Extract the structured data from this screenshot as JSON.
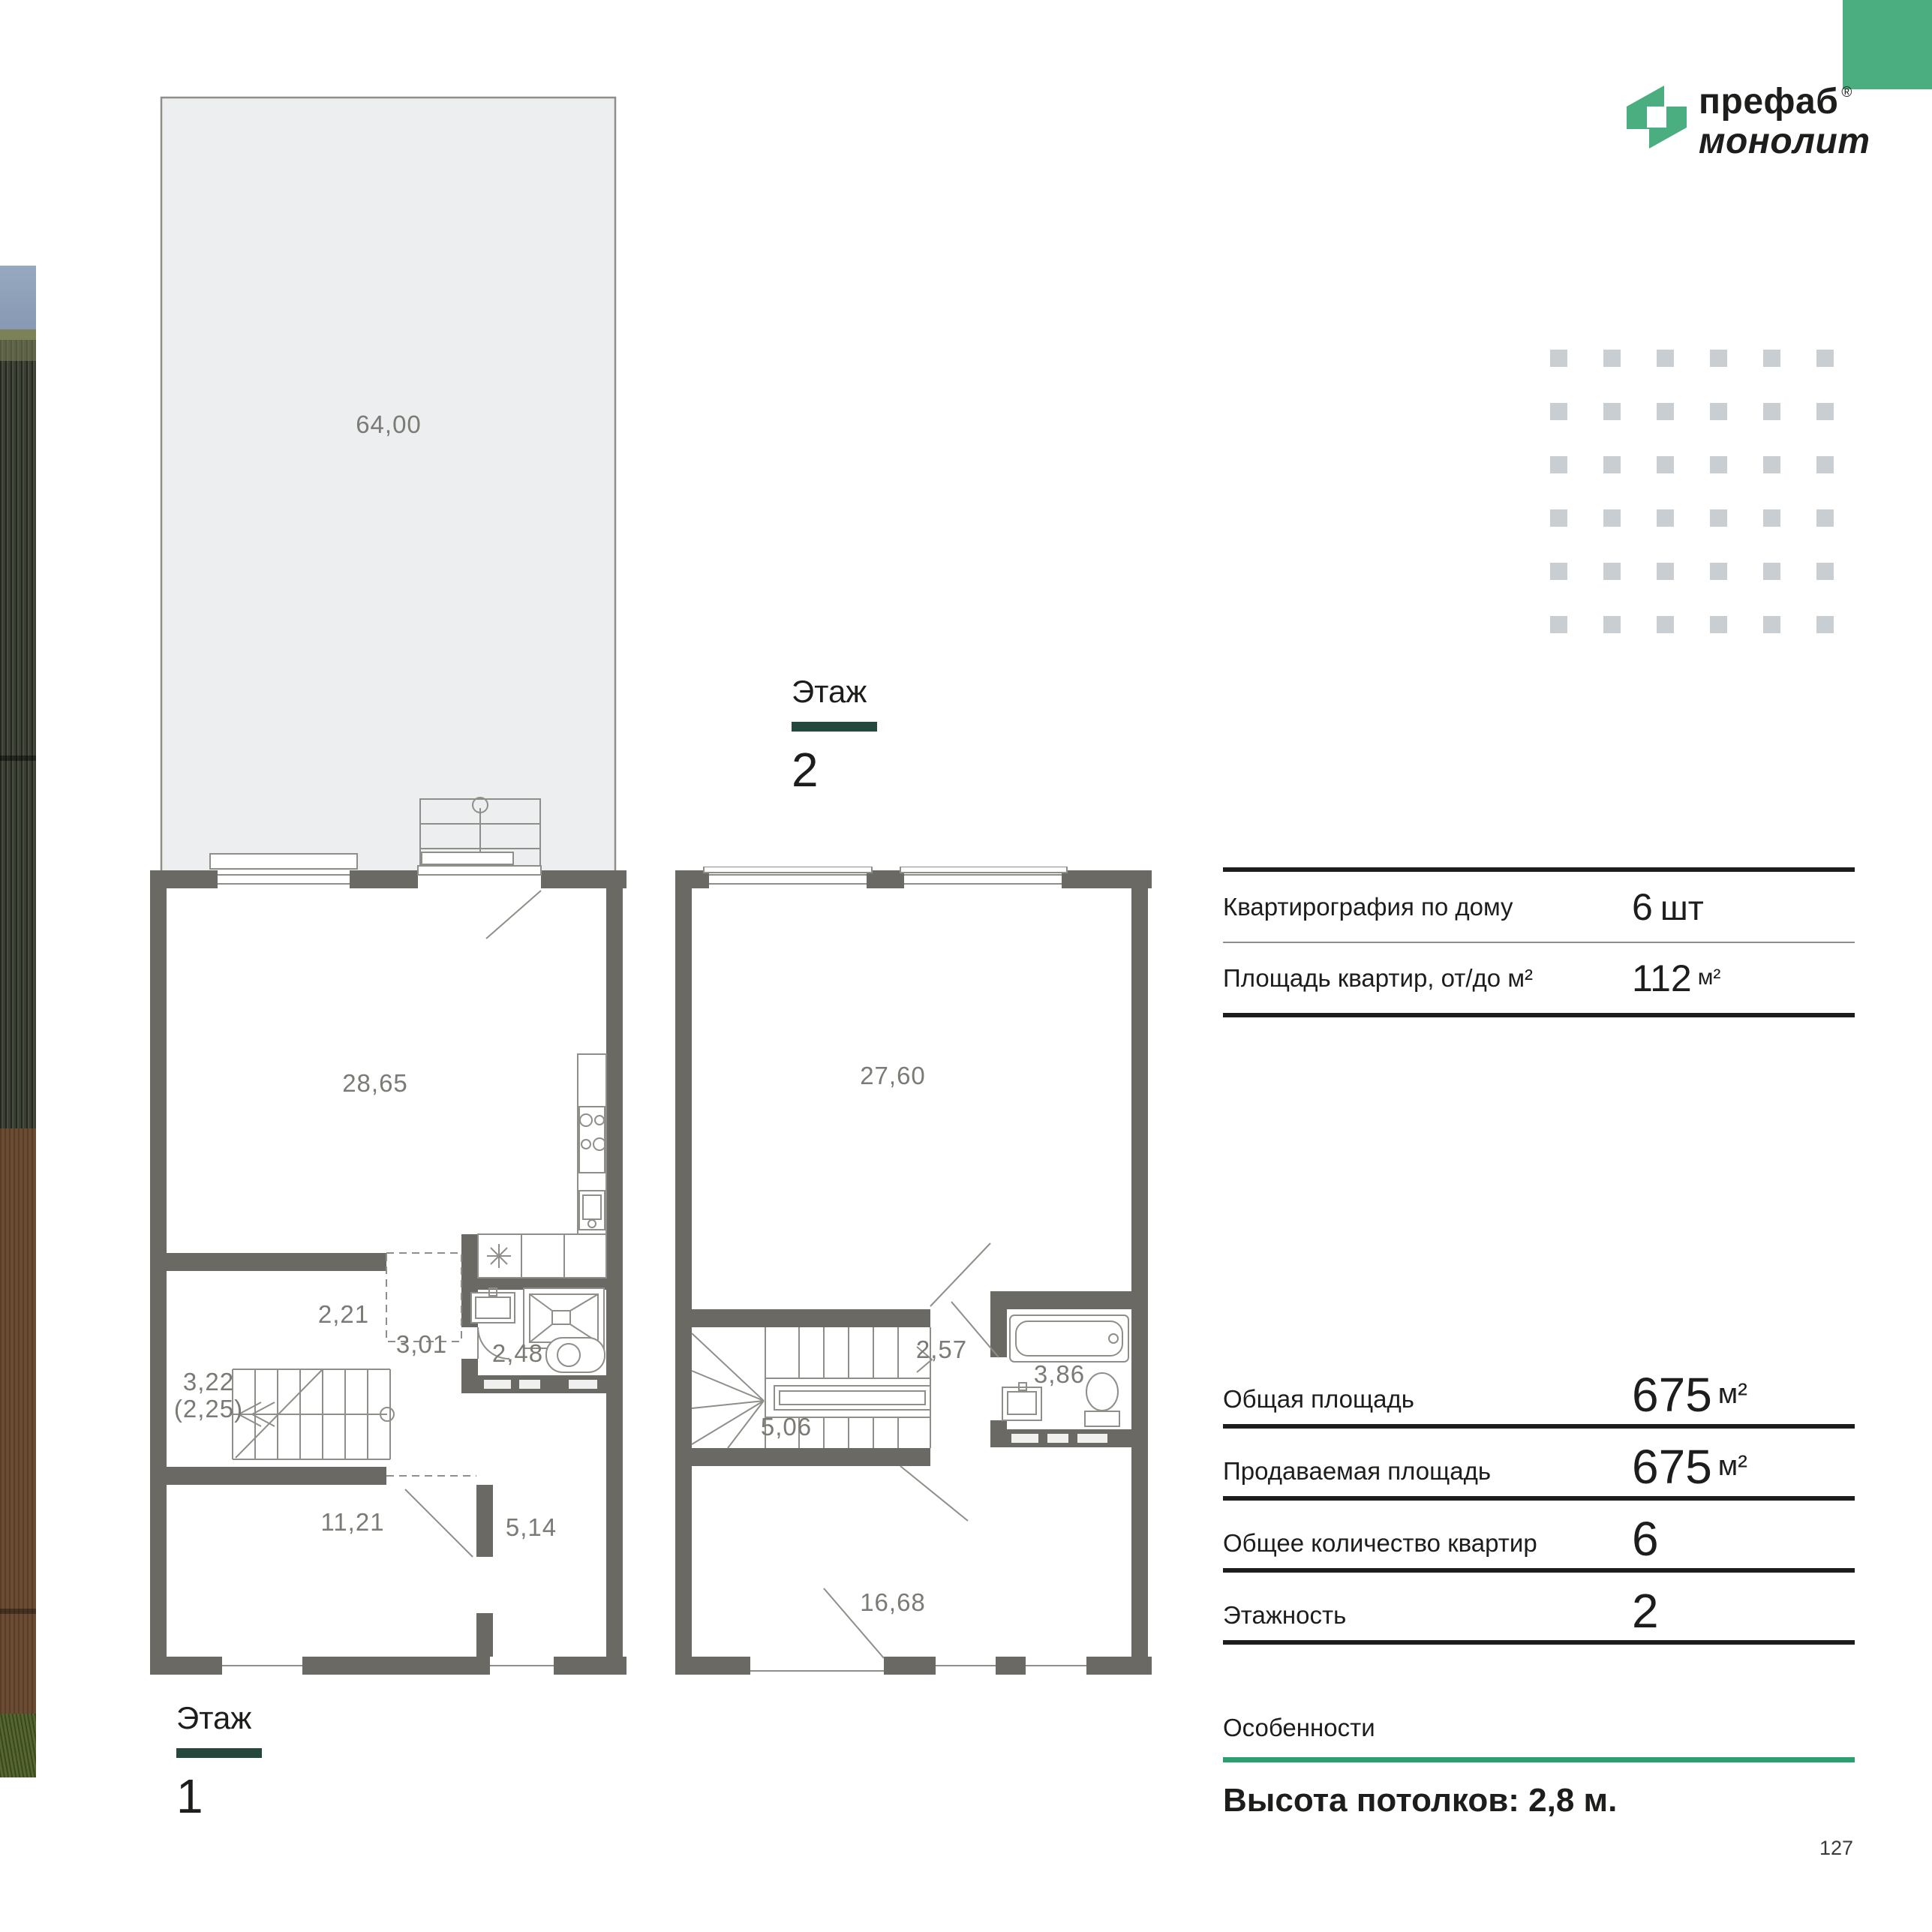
{
  "brand": {
    "line1": "префаб",
    "reg": "®",
    "line2": "монолит",
    "accent_green": "#4bae81",
    "bar_teal": "#24483d"
  },
  "floors": {
    "floor2": {
      "label": "Этаж",
      "number": "2"
    },
    "floor1": {
      "label": "Этаж",
      "number": "1"
    }
  },
  "plan1": {
    "terrace": "64,00",
    "living": "28,65",
    "hall_top": "2,21",
    "stairs": "3,22",
    "stairs_alt": "(2,25)",
    "hall": "3,01",
    "bathroom": "2,48",
    "room_left": "11,21",
    "room_right": "5,14"
  },
  "plan2": {
    "living": "27,60",
    "hall": "2,57",
    "bathroom": "3,86",
    "stairs": "5,06",
    "bedroom": "16,68"
  },
  "specs_top": {
    "rows": [
      {
        "label": "Квартирография по дому",
        "value": "6",
        "unit": "шт"
      },
      {
        "label": "Площадь квартир, от/до м²",
        "value": "112",
        "unit": "м²"
      }
    ]
  },
  "specs_main": {
    "rows": [
      {
        "label": "Общая площадь",
        "value": "675",
        "unit": "м²"
      },
      {
        "label": "Продаваемая площадь",
        "value": "675",
        "unit": "м²"
      },
      {
        "label": "Общее количество квартир",
        "value": "6",
        "unit": ""
      },
      {
        "label": "Этажность",
        "value": "2",
        "unit": ""
      }
    ]
  },
  "features": {
    "title": "Особенности",
    "text": "Высота потолков: 2,8 м.",
    "underline_green": "#2aa071"
  },
  "page_number": "127"
}
